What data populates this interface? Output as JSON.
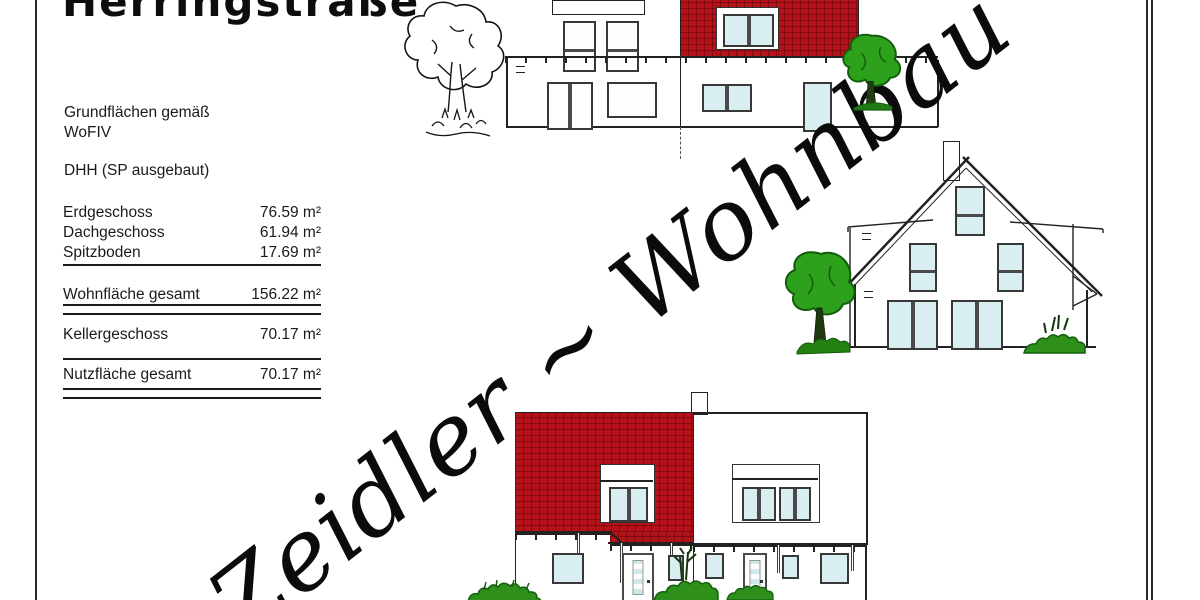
{
  "title": "Herringstraße",
  "info": {
    "line1": "Grundflächen gemäß",
    "line2": "WoFIV",
    "dhh": "DHH (SP ausgebaut)"
  },
  "area_table": {
    "rows": [
      {
        "label": "Erdgeschoss",
        "value": "76.59 m²"
      },
      {
        "label": "Dachgeschoss",
        "value": "61.94 m²"
      },
      {
        "label": "Spitzboden",
        "value": "17.69 m²"
      },
      {
        "label": "Wohnfläche gesamt",
        "value": "156.22 m²"
      },
      {
        "label": "Kellergeschoss",
        "value": "70.17 m²"
      },
      {
        "label": "Nutzfläche gesamt",
        "value": "70.17 m²"
      }
    ]
  },
  "watermark": "Zeidler ~ Wohnbau",
  "colors": {
    "roof_red": "#b3121a",
    "window_glass": "#d9eef1",
    "window_frame": "#4a4a4a",
    "foliage_green": "#2e8f1a",
    "line_black": "#222222"
  }
}
